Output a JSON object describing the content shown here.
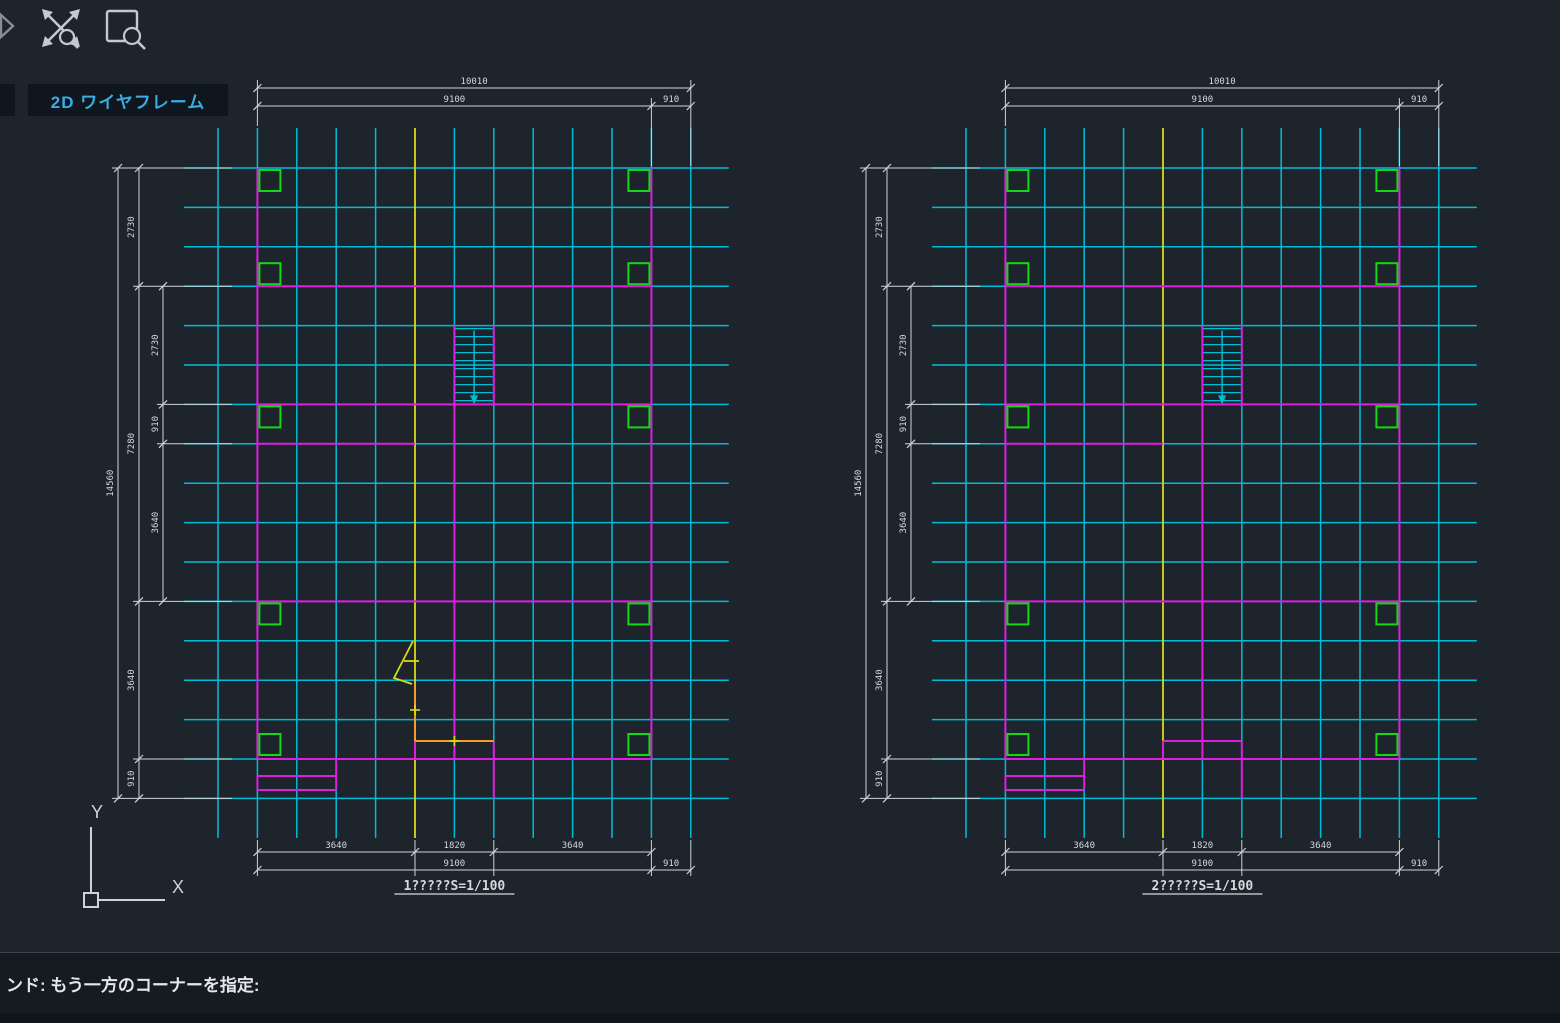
{
  "toolbar": {
    "icons": [
      {
        "name": "flyout-chevron-icon"
      },
      {
        "name": "zoom-extents-icon"
      },
      {
        "name": "zoom-window-icon"
      }
    ]
  },
  "viewport": {
    "label": "2D ワイヤフレーム"
  },
  "command_bar": {
    "prompt": "ンド: もう一方のコーナーを指定:"
  },
  "ucs": {
    "x_label": "X",
    "y_label": "Y"
  },
  "colors": {
    "background": "#1e242c",
    "grid": "#00bdd6",
    "structure": "#de1ede",
    "column_marker": "#12d912",
    "highlight": "#d9d91c",
    "tracking": "#f49b28",
    "dimension": "#ced3d8",
    "dim_text": "#d4d9dd",
    "viewport_label": "#38aee4",
    "command_text": "#e4e7ea",
    "icon": "#c3c9ce"
  },
  "plans": [
    {
      "name": "floor-plan-1",
      "title": "1?????S=1/100",
      "origin_x": 218,
      "rubber_band": true
    },
    {
      "name": "floor-plan-2",
      "title": "2?????S=1/100",
      "origin_x": 966,
      "rubber_band": false
    }
  ],
  "dimensions": {
    "top": {
      "total": "10010",
      "main": "9100",
      "side": "910"
    },
    "bottom": {
      "segments": [
        "3640",
        "1820",
        "3640"
      ],
      "total": "9100",
      "side": "910"
    },
    "left": {
      "total": "14560",
      "outer_chain": [
        "2730",
        "7280",
        "3640",
        "910"
      ],
      "inner_chain": [
        "2730",
        "910",
        "3640"
      ]
    }
  },
  "grid": {
    "pitch": 39.4,
    "origin_y": 168,
    "cols": 13,
    "rows": 17,
    "yellow_col": 5
  }
}
